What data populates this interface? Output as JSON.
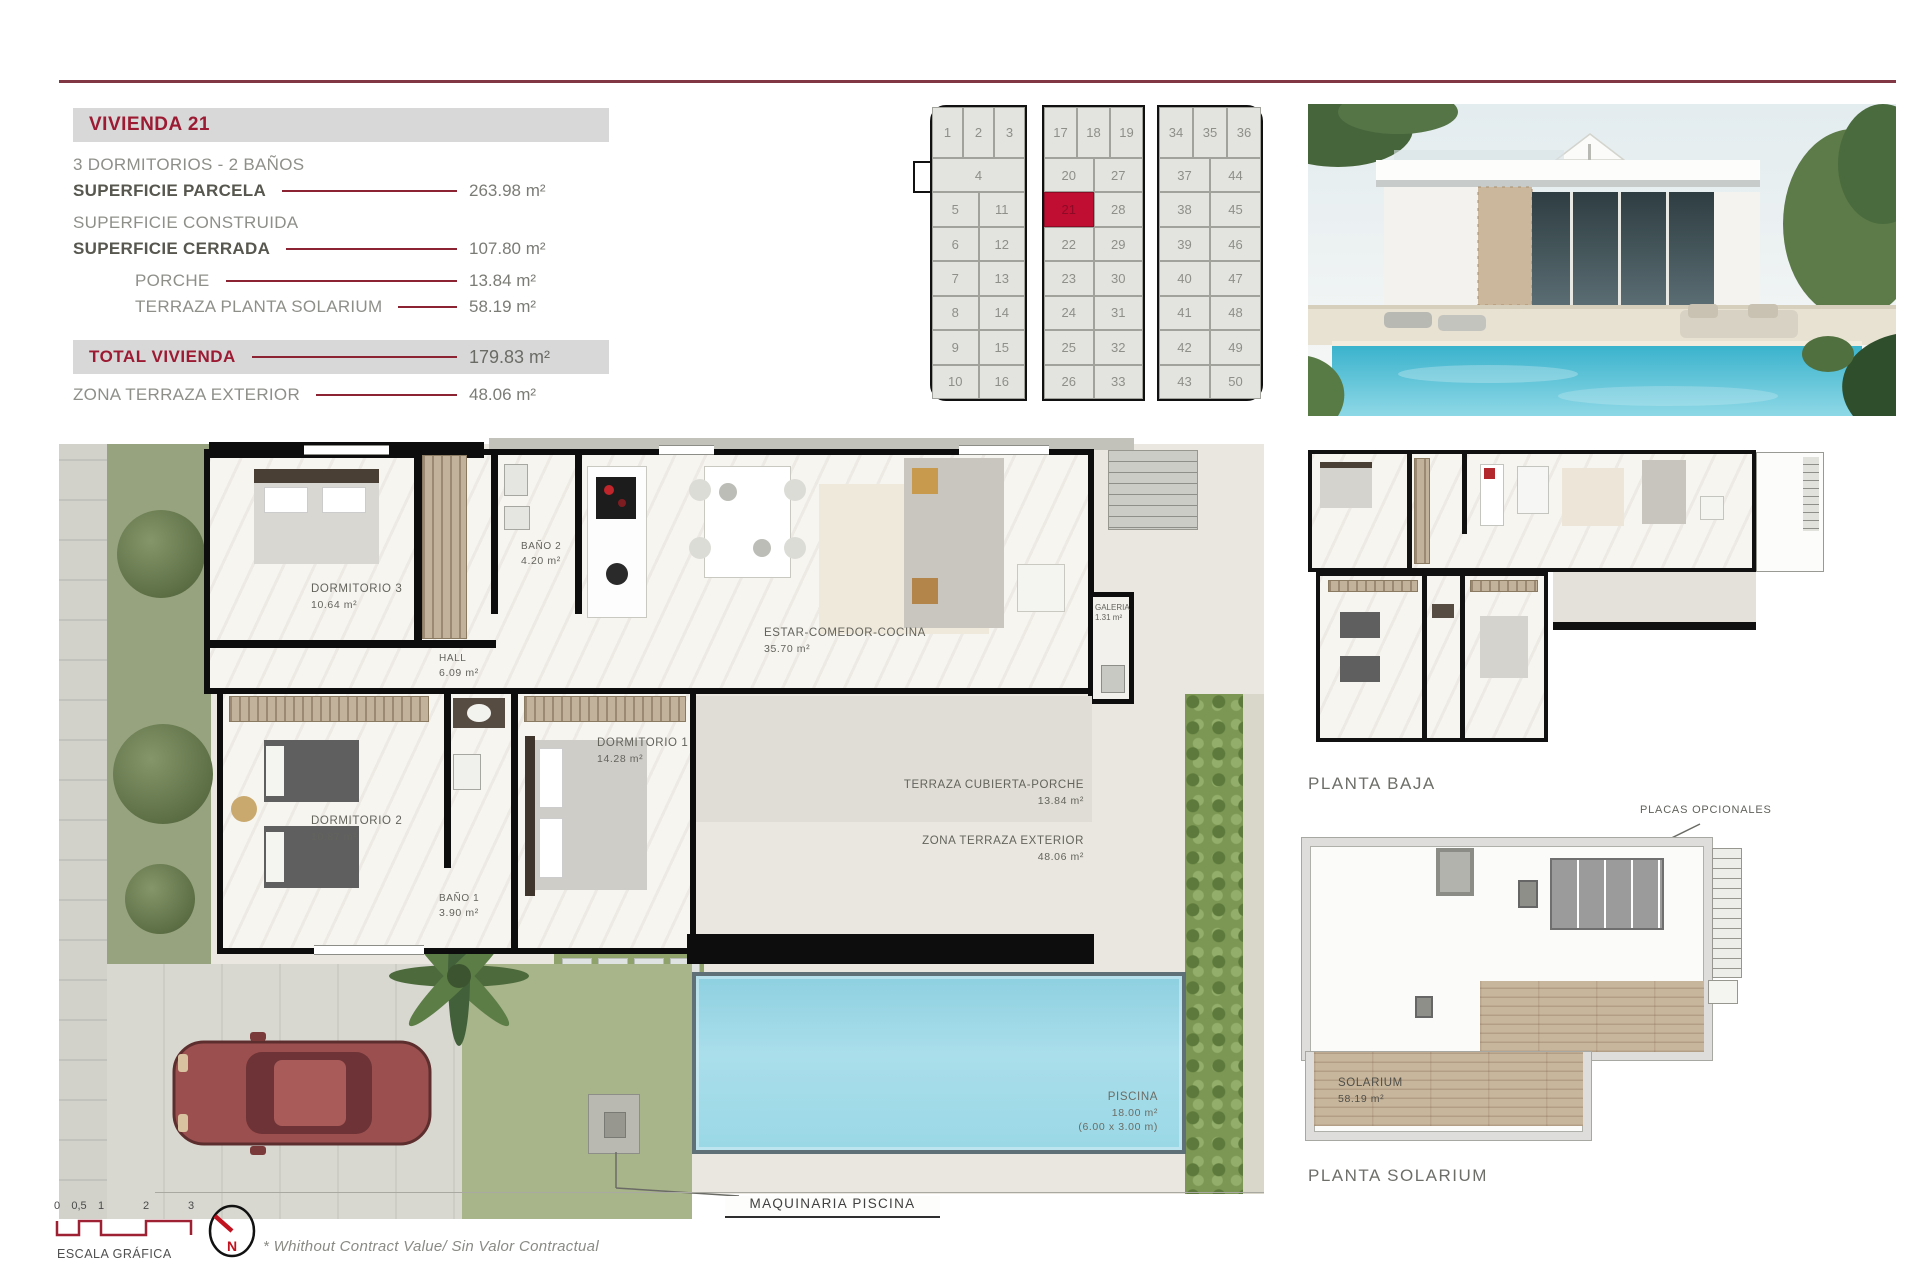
{
  "colors": {
    "accent_maroon": "#8c2333",
    "title_red": "#9c1b33",
    "highlight_plot_red": "#c00d32",
    "bar_gray": "#d8d8d8",
    "pool_blue": "#a5dbe7"
  },
  "info_panel": {
    "title": "VIVIENDA 21",
    "subtitle": "3 DORMITORIOS - 2 BAÑOS",
    "rows": [
      {
        "label": "SUPERFICIE PARCELA",
        "value": "263.98 m²"
      },
      {
        "label": "SUPERFICIE CONSTRUIDA",
        "value": ""
      },
      {
        "label": "SUPERFICIE CERRADA",
        "value": "107.80 m²"
      },
      {
        "label": "PORCHE",
        "value": "13.84 m²"
      },
      {
        "label": "TERRAZA PLANTA SOLARIUM",
        "value": "58.19 m²"
      }
    ],
    "total": {
      "label": "TOTAL VIVIENDA",
      "value": "179.83 m²"
    },
    "extra": {
      "label": "ZONA TERRAZA EXTERIOR",
      "value": "48.06 m²"
    }
  },
  "site_grid": {
    "highlight": "21",
    "blocks": [
      {
        "header": [
          "1",
          "2",
          "3"
        ],
        "wide": "4",
        "rows": [
          [
            "5",
            "11"
          ],
          [
            "6",
            "12"
          ],
          [
            "7",
            "13"
          ],
          [
            "8",
            "14"
          ],
          [
            "9",
            "15"
          ],
          [
            "10",
            "16"
          ]
        ]
      },
      {
        "header": [
          "17",
          "18",
          "19"
        ],
        "rows": [
          [
            "20",
            "27"
          ],
          [
            "21",
            "28"
          ],
          [
            "22",
            "29"
          ],
          [
            "23",
            "30"
          ],
          [
            "24",
            "31"
          ],
          [
            "25",
            "32"
          ],
          [
            "26",
            "33"
          ]
        ]
      },
      {
        "header": [
          "34",
          "35",
          "36"
        ],
        "rows": [
          [
            "37",
            "44"
          ],
          [
            "38",
            "45"
          ],
          [
            "39",
            "46"
          ],
          [
            "40",
            "47"
          ],
          [
            "41",
            "48"
          ],
          [
            "42",
            "49"
          ],
          [
            "43",
            "50"
          ]
        ]
      }
    ]
  },
  "floor_plan": {
    "rooms": [
      {
        "name": "DORMITORIO 3",
        "area": "10.64 m²"
      },
      {
        "name": "BAÑO 2",
        "area": "4.20 m²"
      },
      {
        "name": "HALL",
        "area": "6.09 m²"
      },
      {
        "name": "ESTAR-COMEDOR-COCINA",
        "area": "35.70 m²"
      },
      {
        "name": "DORMITORIO 1",
        "area": "14.28 m²"
      },
      {
        "name": "DORMITORIO 2",
        "area": "10.87 m²"
      },
      {
        "name": "BAÑO 1",
        "area": "3.90 m²"
      },
      {
        "name": "GALERIA",
        "area": "1.31 m²"
      },
      {
        "name": "TERRAZA CUBIERTA-PORCHE",
        "area": "13.84 m²"
      },
      {
        "name": "ZONA TERRAZA EXTERIOR",
        "area": "48.06 m²"
      },
      {
        "name": "PISCINA",
        "area": "18.00 m²",
        "dims": "(6.00 x 3.00 m)"
      },
      {
        "name": "SOLARIUM",
        "area": "58.19 m²"
      }
    ],
    "machine_label": "MAQUINARIA PISCINA"
  },
  "mini_plans": {
    "baja_label": "PLANTA BAJA",
    "solarium_label": "PLANTA SOLARIUM",
    "placas_label": "PLACAS OPCIONALES"
  },
  "footer": {
    "scale_ticks": [
      "0",
      "0,5",
      "1",
      "2",
      "3"
    ],
    "scale_label": "ESCALA GRÁFICA",
    "north_label": "N",
    "disclaimer": "*  Whithout Contract Value/ Sin Valor Contractual"
  }
}
